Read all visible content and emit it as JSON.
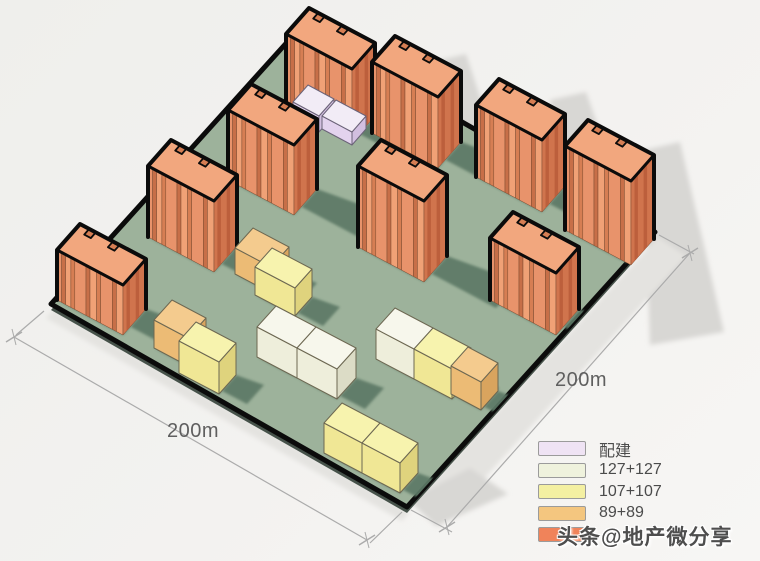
{
  "dimensions": {
    "left_label": "200m",
    "right_label": "200m",
    "left_line": {
      "a": [
        14,
        337
      ],
      "b": [
        367,
        540
      ],
      "ext1": [
        [
          44,
          311
        ],
        [
          16,
          335
        ]
      ],
      "ext2": [
        [
          402,
          512
        ],
        [
          370,
          543
        ]
      ]
    },
    "right_line": {
      "a": [
        690,
        253
      ],
      "b": [
        447,
        527
      ],
      "ext1": [
        [
          659,
          235
        ],
        [
          694,
          254
        ]
      ],
      "ext2": [
        [
          411,
          510
        ],
        [
          452,
          532
        ]
      ]
    }
  },
  "legend": {
    "items": [
      {
        "label": "配建",
        "color": "#efe3f4"
      },
      {
        "label": "127+127",
        "color": "#eff2dd"
      },
      {
        "label": "107+107",
        "color": "#f4f0a2"
      },
      {
        "label": "89+89",
        "color": "#f4c67f"
      },
      {
        "label": "",
        "color": "#f0835a"
      }
    ]
  },
  "watermark": {
    "text": "头条@地产微分享"
  },
  "site": {
    "corners": [
      [
        299,
        29
      ],
      [
        655,
        232
      ],
      [
        407,
        507
      ],
      [
        51,
        304
      ]
    ]
  },
  "towers": [
    {
      "o": [
        309,
        8
      ],
      "h": 73
    },
    {
      "o": [
        395,
        36
      ],
      "h": 71
    },
    {
      "o": [
        251,
        84
      ],
      "h": 70
    },
    {
      "o": [
        499,
        79
      ],
      "h": 72
    },
    {
      "o": [
        171,
        140
      ],
      "h": 71
    },
    {
      "o": [
        588,
        120
      ],
      "h": 84
    },
    {
      "o": [
        381,
        140
      ],
      "h": 81
    },
    {
      "o": [
        80,
        224
      ],
      "h": 50
    },
    {
      "o": [
        513,
        212
      ],
      "h": 62
    }
  ],
  "tower_axes": {
    "u": [
      66,
      35
    ],
    "v": [
      -23,
      26
    ]
  },
  "podium": [
    {
      "o": [
        308,
        85
      ],
      "u": [
        26,
        14
      ],
      "v": [
        -15,
        17
      ],
      "h": 16
    },
    {
      "o": [
        336,
        100
      ],
      "u": [
        30,
        16
      ],
      "v": [
        -14,
        16
      ],
      "h": 13
    }
  ],
  "blocks": [
    {
      "t": "tan89",
      "o": [
        253,
        228
      ],
      "u": [
        36,
        19
      ],
      "v": [
        -18,
        20
      ],
      "h": 26
    },
    {
      "t": "yellow107",
      "o": [
        272,
        248
      ],
      "u": [
        40,
        21
      ],
      "v": [
        -17,
        19
      ],
      "h": 28
    },
    {
      "t": "white127",
      "o": [
        395,
        308
      ],
      "u": [
        38,
        20
      ],
      "v": [
        -19,
        21
      ],
      "h": 30
    },
    {
      "t": "yellow107",
      "o": [
        433,
        328
      ],
      "u": [
        38,
        20
      ],
      "v": [
        -19,
        21
      ],
      "h": 30
    },
    {
      "t": "tan89",
      "o": [
        468,
        347
      ],
      "u": [
        30,
        16
      ],
      "v": [
        -17,
        19
      ],
      "h": 28
    },
    {
      "t": "tan89",
      "o": [
        172,
        300
      ],
      "u": [
        34,
        18
      ],
      "v": [
        -18,
        20
      ],
      "h": 28
    },
    {
      "t": "yellow107",
      "o": [
        196,
        322
      ],
      "u": [
        40,
        21
      ],
      "v": [
        -17,
        19
      ],
      "h": 32
    },
    {
      "t": "white127",
      "o": [
        276,
        306
      ],
      "u": [
        40,
        21
      ],
      "v": [
        -19,
        21
      ],
      "h": 30
    },
    {
      "t": "white127",
      "o": [
        316,
        327
      ],
      "u": [
        40,
        21
      ],
      "v": [
        -19,
        21
      ],
      "h": 30
    },
    {
      "t": "yellow107",
      "o": [
        342,
        403
      ],
      "u": [
        38,
        20
      ],
      "v": [
        -18,
        20
      ],
      "h": 30
    },
    {
      "t": "yellow107",
      "o": [
        380,
        423
      ],
      "u": [
        38,
        20
      ],
      "v": [
        -18,
        20
      ],
      "h": 30
    }
  ],
  "ground_shadows": [
    {
      "pts": [
        [
          432,
          62
        ],
        [
          466,
          54
        ],
        [
          500,
          158
        ],
        [
          455,
          170
        ]
      ],
      "light": false
    },
    {
      "pts": [
        [
          550,
          100
        ],
        [
          586,
          92
        ],
        [
          624,
          200
        ],
        [
          572,
          212
        ]
      ],
      "light": false
    },
    {
      "pts": [
        [
          644,
          150
        ],
        [
          680,
          142
        ],
        [
          724,
          332
        ],
        [
          650,
          345
        ]
      ],
      "light": false
    },
    {
      "pts": [
        [
          412,
          504
        ],
        [
          658,
          237
        ],
        [
          686,
          256
        ],
        [
          440,
          527
        ]
      ],
      "light": true
    },
    {
      "pts": [
        [
          408,
          500
        ],
        [
          470,
          468
        ],
        [
          508,
          494
        ],
        [
          436,
          526
        ]
      ],
      "light": false
    },
    {
      "pts": [
        [
          54,
          310
        ],
        [
          410,
          512
        ],
        [
          402,
          521
        ],
        [
          46,
          318
        ]
      ],
      "light": true
    }
  ],
  "colors": {
    "background": "#f2f1ef",
    "site_green": "#9db29b",
    "site_outline": "#0b0b0b",
    "shadow_green": "#5d7966",
    "shadow_white": "#d8d7d4",
    "shadow_white_light": "#e4e3e0",
    "tower_roof": "#f2a77e",
    "tower_face_base": "#e8936b",
    "tower_face_dark": "#c76f48",
    "tower_face_light": "#f0a176",
    "tower_face_mid": "#d67e53",
    "tower_side": "#d0744d",
    "tower_side_dark": "#bc5f3c",
    "block_outline": "#6d6852",
    "lavender_top": "#f2ecf6",
    "lavender_left": "#e3d3ee",
    "lavender_right": "#d2bfe0",
    "white_top": "#f7f7ec",
    "white_left": "#eeeedb",
    "white_right": "#dcdcc6",
    "yellow_top": "#f7f3ae",
    "yellow_left": "#f0e795",
    "yellow_right": "#dfd37d",
    "tan_top": "#f4cb8e",
    "tan_left": "#ecbb75",
    "tan_right": "#d9a45e",
    "dim_line": "#ababab",
    "dim_text": "#5f5f5f"
  }
}
